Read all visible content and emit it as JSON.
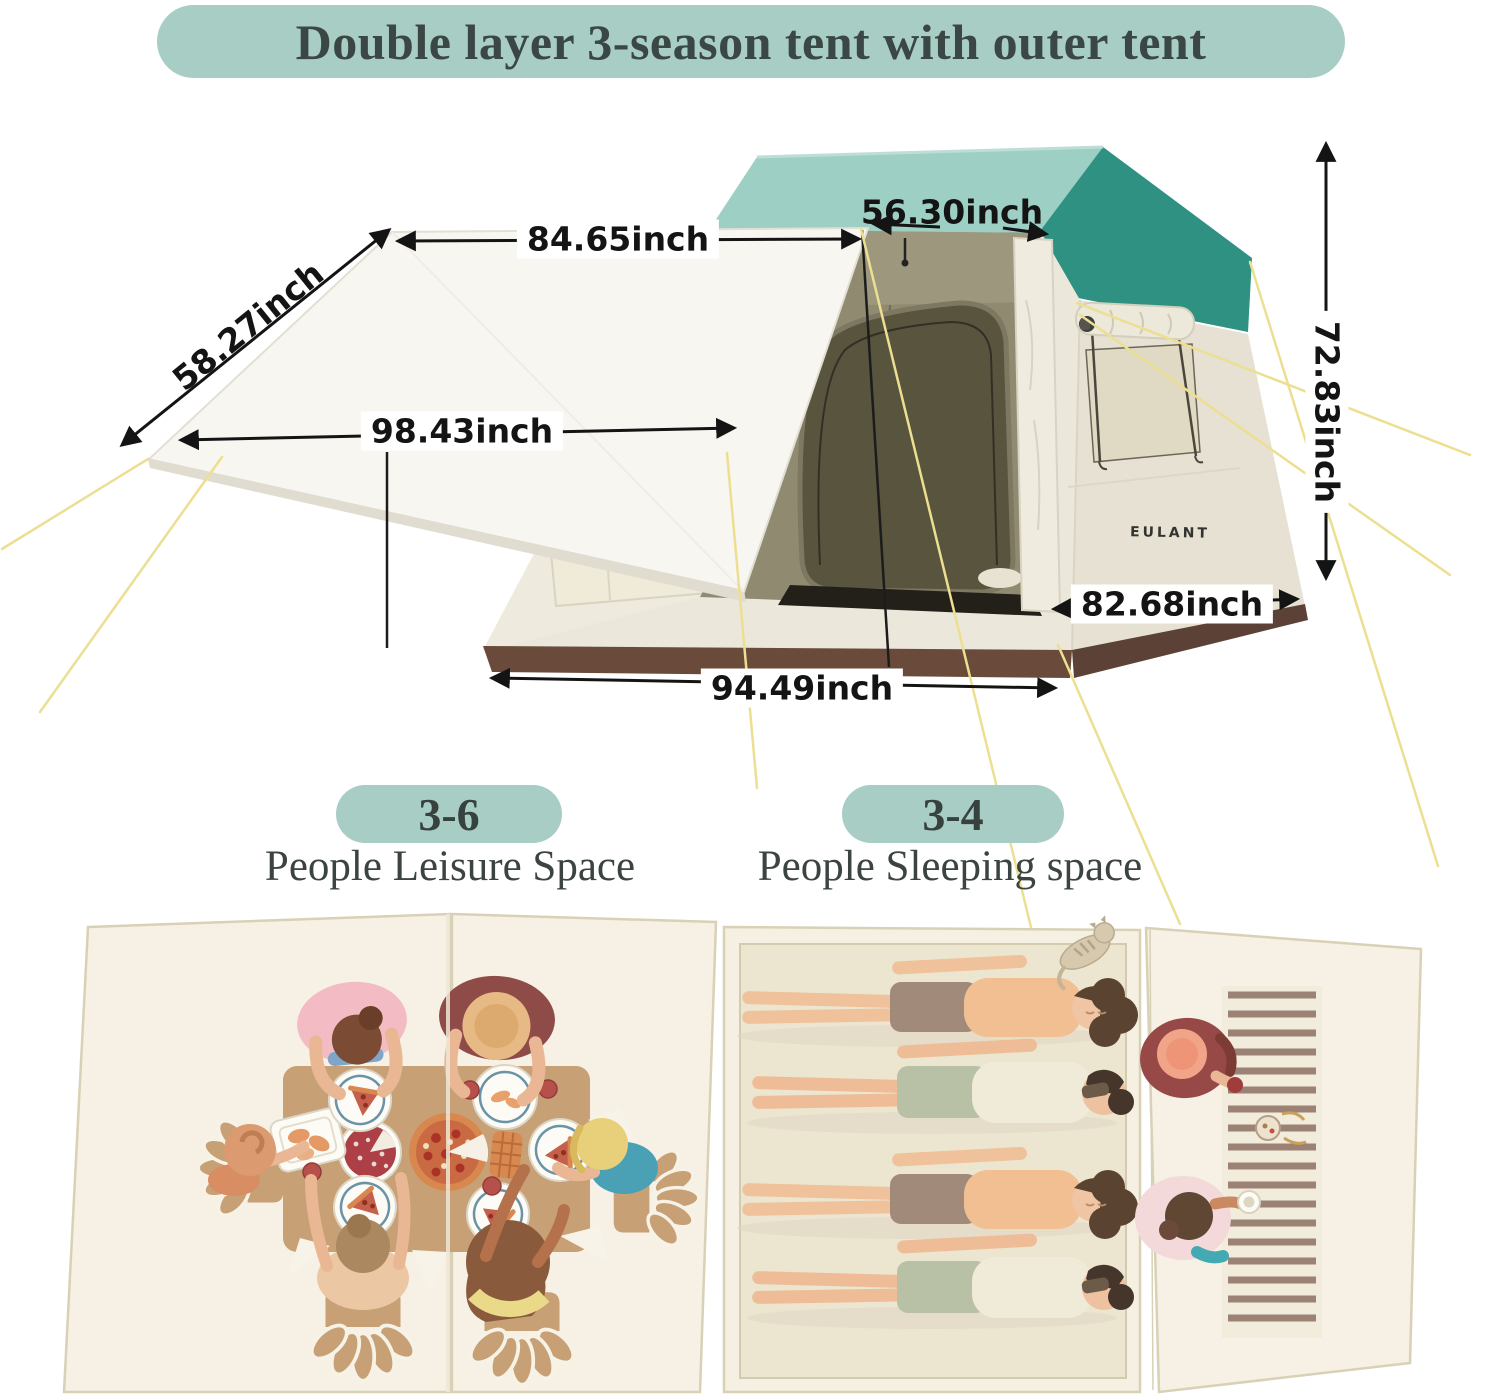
{
  "title": "Double layer 3-season tent with outer tent",
  "tent": {
    "brand": "EULANT",
    "dimensions": {
      "awning_top_width": "84.65inch",
      "roof_top_width": "56.30inch",
      "awning_side_depth": "58.27inch",
      "awning_front_width": "98.43inch",
      "tent_height": "72.83inch",
      "side_depth": "82.68inch",
      "front_width": "94.49inch"
    }
  },
  "capacity_badges": [
    {
      "value": "3-6",
      "label": "People Leisure Space"
    },
    {
      "value": "3-4",
      "label": "People Sleeping space"
    }
  ],
  "icons": {
    "dimension_arrow": "double-headed-arrow",
    "guy_line": "tent-guy-line"
  },
  "colors": {
    "badge_teal": "#a8cdc5",
    "title_text": "#3a4744",
    "roof_light_teal": "#9ecfc4",
    "roof_dark_teal": "#2e9181",
    "tent_body_cream": "#ebe7da",
    "skirt_brown": "#6a4b3b",
    "guyline_yellow": "#ecdf92",
    "dimension_black": "#141414",
    "panel_cream": "#f6f1e4",
    "table_tan": "#c7a076",
    "mat_stripe_brown": "#9c8274"
  }
}
